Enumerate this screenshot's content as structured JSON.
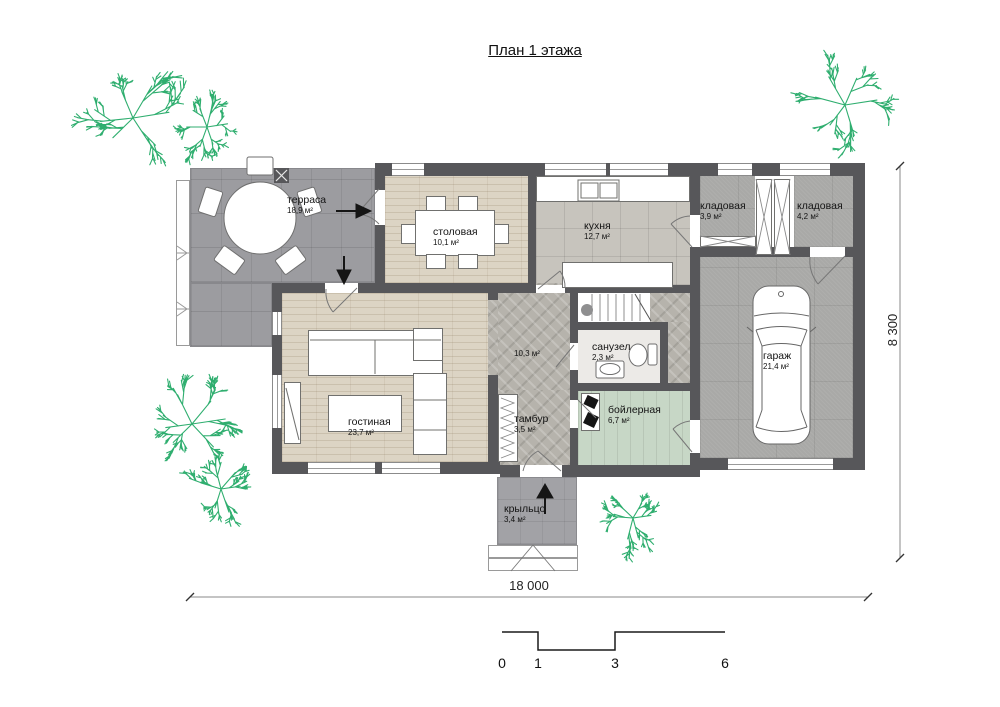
{
  "title": "План 1 этажа",
  "rooms": [
    {
      "name": "терраса",
      "area": "18,9 м²"
    },
    {
      "name": "столовая",
      "area": "10,1 м²"
    },
    {
      "name": "кухня",
      "area": "12,7 м²"
    },
    {
      "name": "кладовая",
      "area": "3,9 м²"
    },
    {
      "name": "кладовая",
      "area": "4,2 м²"
    },
    {
      "name": "гараж",
      "area": "21,4 м²"
    },
    {
      "name": "гостиная",
      "area": "23,7 м²"
    },
    {
      "name": "",
      "area": "10,3 м²"
    },
    {
      "name": "санузел",
      "area": "2,3 м²"
    },
    {
      "name": "тамбур",
      "area": "3,5 м²"
    },
    {
      "name": "бойлерная",
      "area": "6,7 м²"
    },
    {
      "name": "крыльцо",
      "area": "3,4 м²"
    }
  ],
  "dimensions": {
    "width_label": "18 000",
    "height_label": "8 300"
  },
  "scale_bar": {
    "labels": [
      "0",
      "1",
      "3",
      "6"
    ]
  },
  "icons": {
    "tree": "plan-tree-symbol",
    "car": "car-top-view",
    "entrance_arrow": "black-triangle-arrow",
    "column": "crossed-square"
  },
  "colors": {
    "wall": "#57575a",
    "tree": "#2fae6f",
    "wood_floor": "#dcd4c4",
    "terrace_floor": "#9c9ca0",
    "tile_floor": "#c7c4bd",
    "stone_floor": "#b6b3ac",
    "concrete_floor": "#a9a9a7",
    "boiler_floor": "#c7d7c6",
    "porch_floor": "#a2a2a6"
  }
}
